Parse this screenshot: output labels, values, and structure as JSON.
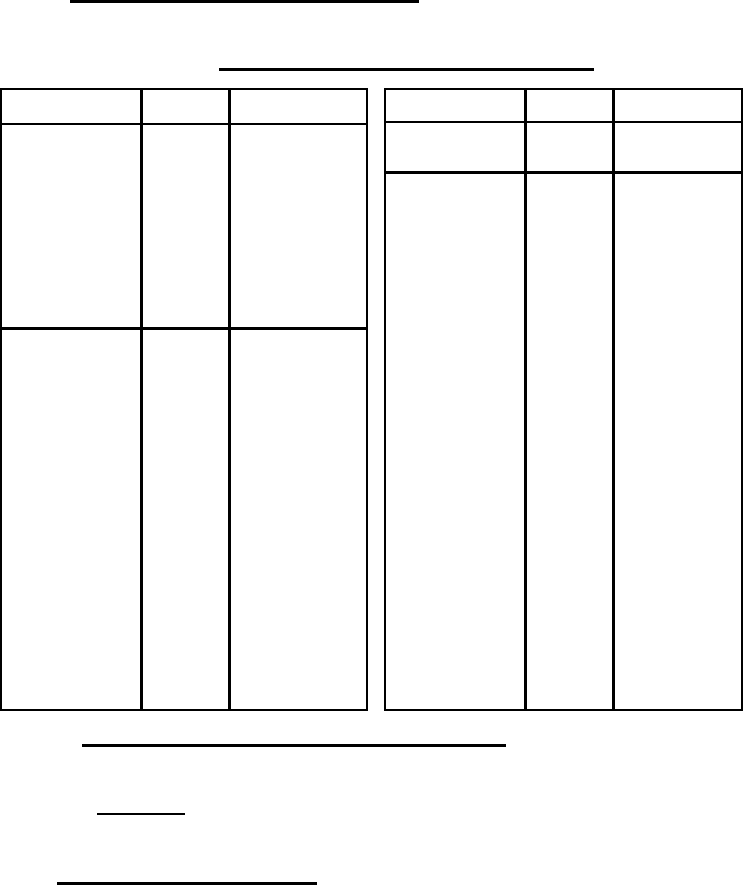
{
  "page": {
    "background_color": "#ffffff",
    "line_color": "#000000",
    "visible_text": ""
  },
  "heading_rules": [
    {
      "name": "top-heading-underline",
      "text": ""
    },
    {
      "name": "table-title-underline",
      "text": ""
    }
  ],
  "left_table": {
    "columns": 3,
    "header": [
      "",
      "",
      ""
    ],
    "rows": [
      {
        "cells": [
          "",
          "",
          ""
        ]
      },
      {
        "cells": [
          "",
          "",
          ""
        ]
      }
    ]
  },
  "right_table": {
    "columns": 3,
    "header": [
      "",
      "",
      ""
    ],
    "rows": [
      {
        "cells": [
          "",
          "",
          ""
        ]
      },
      {
        "cells": [
          "",
          "",
          ""
        ]
      }
    ]
  },
  "footer_rules": [
    {
      "name": "footer-underline-long",
      "text": ""
    },
    {
      "name": "footer-underline-short",
      "text": ""
    },
    {
      "name": "footer-underline-bottom",
      "text": ""
    }
  ]
}
